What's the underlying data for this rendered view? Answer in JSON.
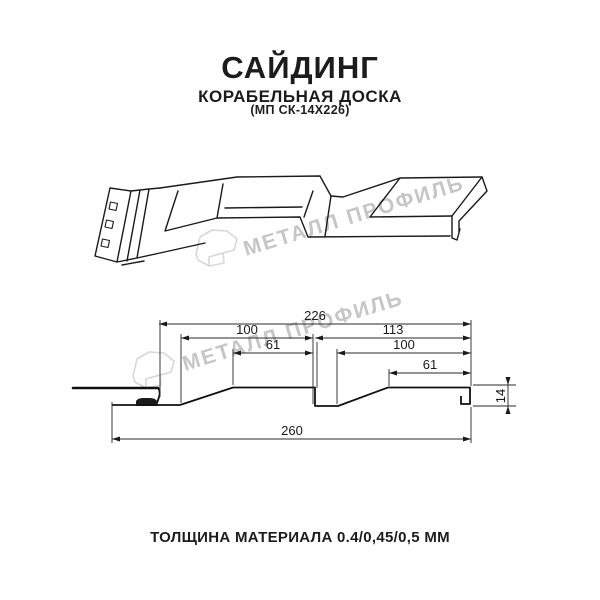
{
  "header": {
    "title": "САЙДИНГ",
    "subtitle": "КОРАБЕЛЬНАЯ ДОСКА",
    "model": "(МП СК-14Х226)"
  },
  "watermark": {
    "brand": "МЕТАЛЛ ПРОФИЛЬ",
    "text_color": "#c6c6c6",
    "logo_color": "#d7d7d7"
  },
  "cross_section": {
    "dim_visible_width": "226",
    "dim_pitch_left": "100",
    "dim_face_left": "61",
    "dim_pitch_right_outer": "113",
    "dim_pitch_right": "100",
    "dim_face_right": "61",
    "dim_height": "14",
    "dim_overall_width": "260"
  },
  "footer": {
    "thickness": "ТОЛЩИНА МАТЕРИАЛА 0.4/0,45/0,5 ММ"
  },
  "colors": {
    "ink": "#1a1a1a",
    "background": "#ffffff"
  }
}
